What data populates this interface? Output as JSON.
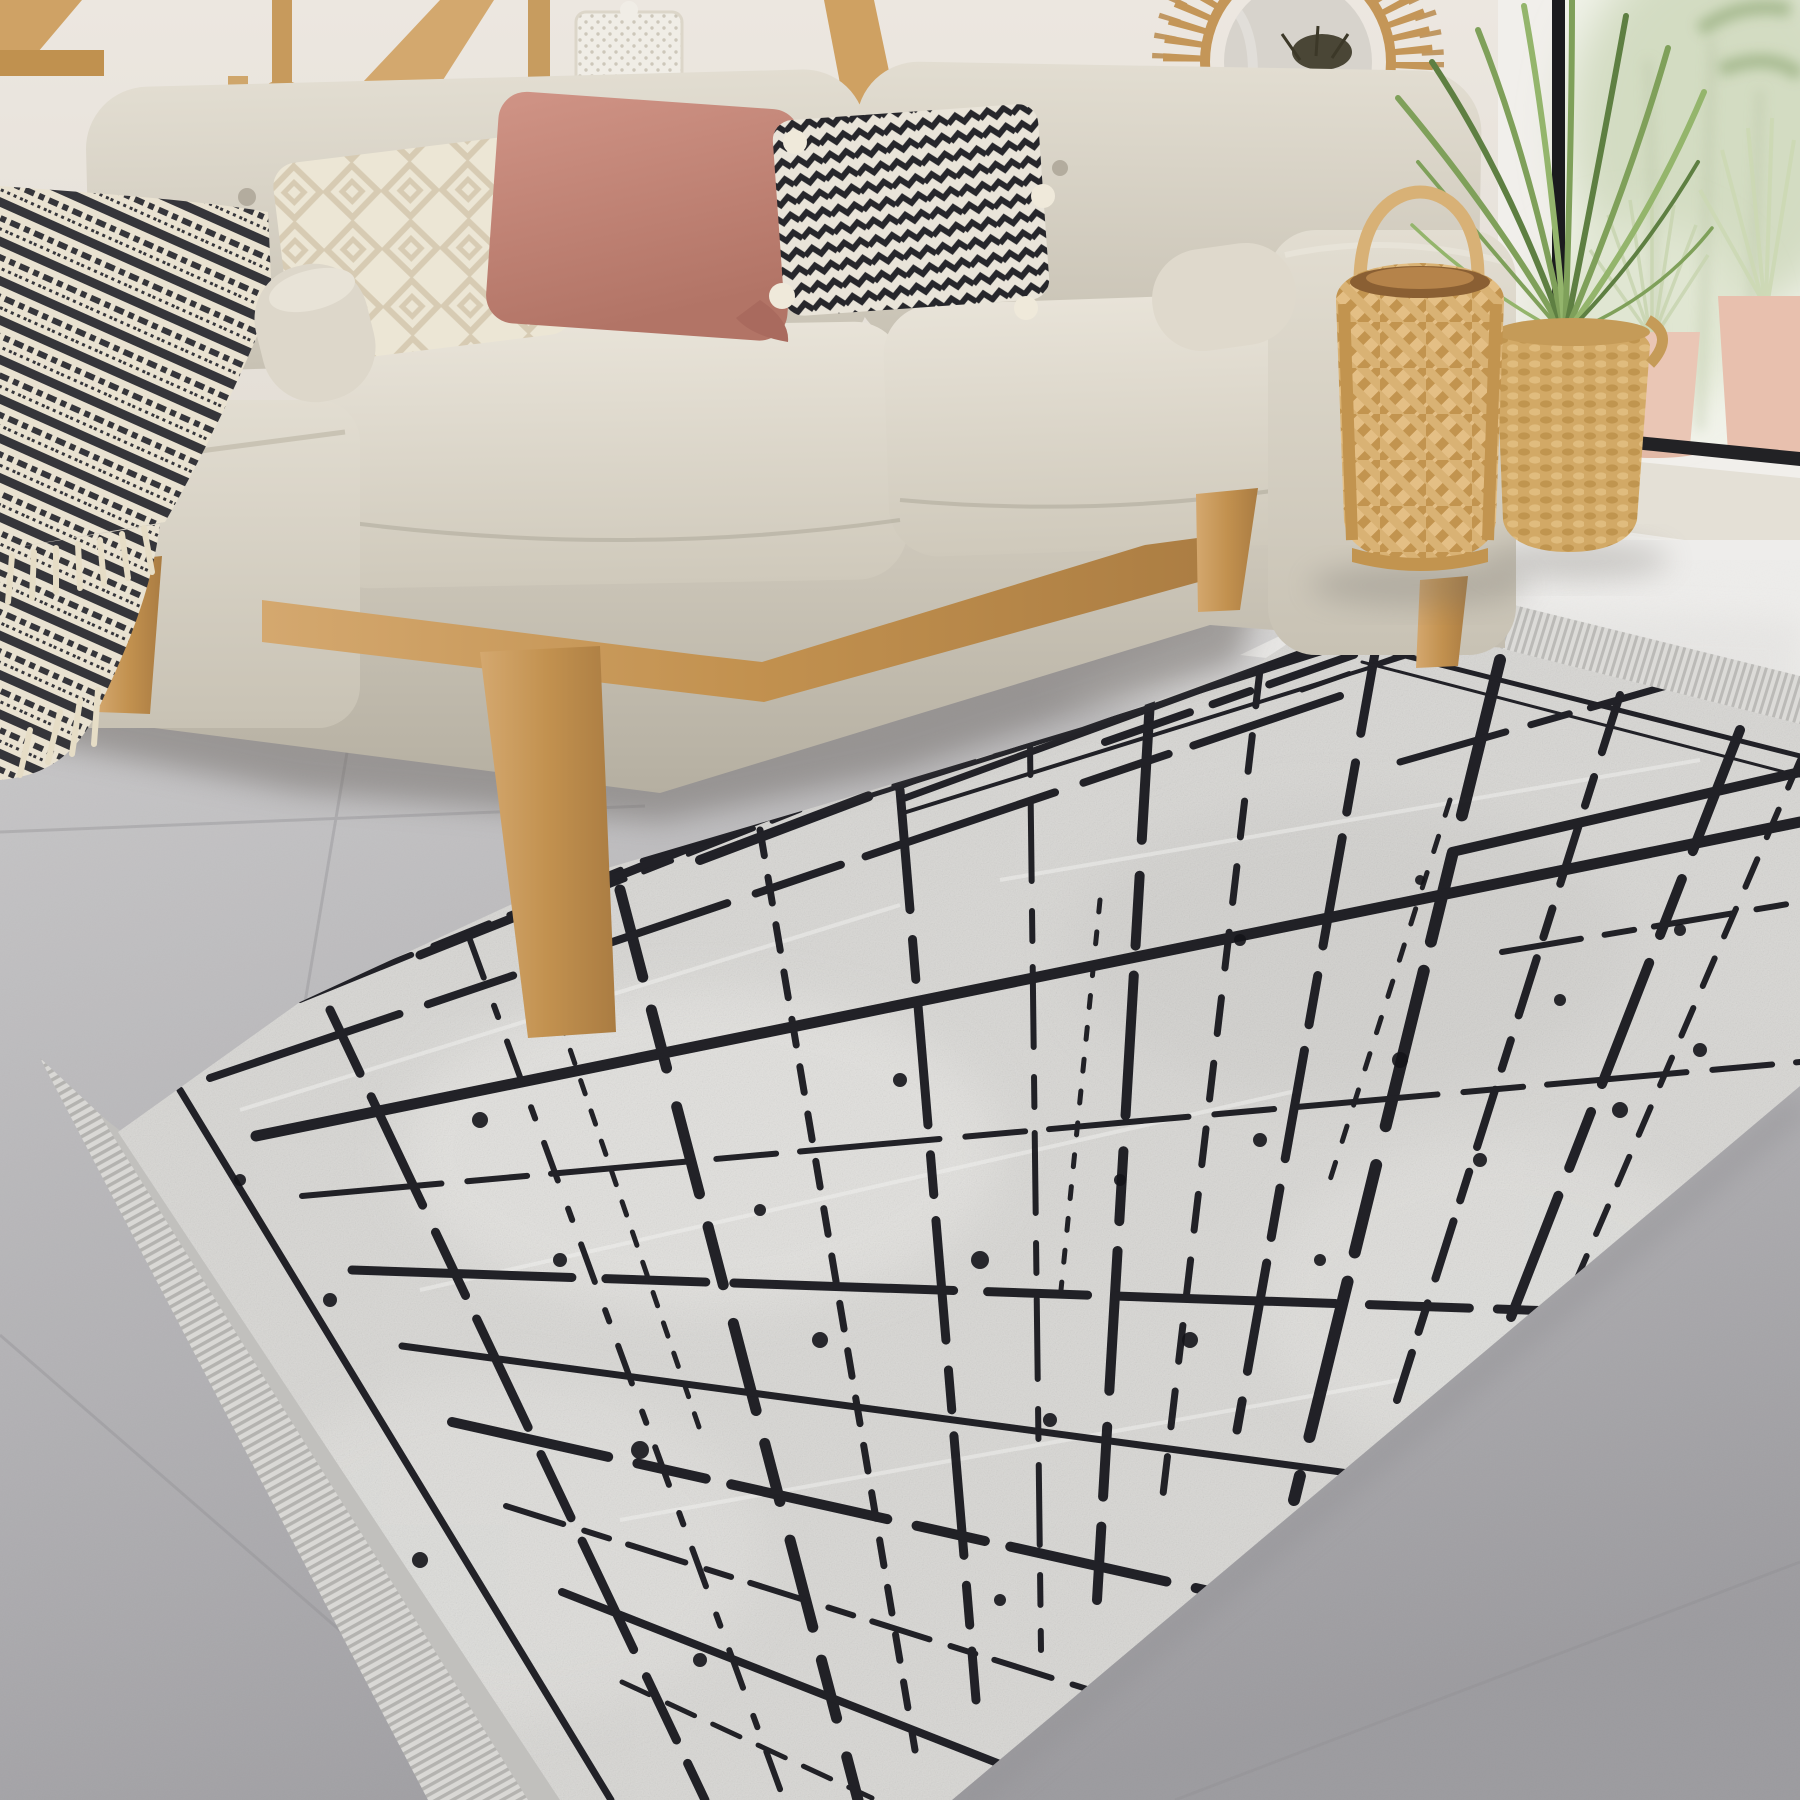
{
  "scene": {
    "type": "photograph",
    "setting": "scandinavian living room",
    "subject": "gray area rug with abstract black scratch-line pattern and fringe, beige sofa, wooden decor"
  },
  "colors": {
    "wall": "#e9e4dd",
    "wall_shadow": "#d8d1c6",
    "wood": "#c59a62",
    "wood_dark": "#a87e49",
    "wood_light": "#dcb987",
    "sofa": "#d6d0c3",
    "sofa_light": "#e6e1d5",
    "sofa_dark": "#b7b1a3",
    "seat_front": "#ccc6b9",
    "pillow_cream": "#ece6d5",
    "pillow_cream_pattern": "#d7cbb3",
    "pillow_pink": "#c98b7d",
    "pillow_pink_dark": "#b07264",
    "chevron_dark": "#26262b",
    "chevron_light": "#e9e4d9",
    "throw_dark": "#35353a",
    "throw_cream": "#e9e2d1",
    "rug_base": "#d8d7d4",
    "rug_line": "#14141a",
    "rug_fringe": "#cbcac7",
    "rug_selvage": "#c1c0bd",
    "floor": "#b5b4b6",
    "floor_dark": "#9e9da1",
    "floor_bright": "#eeedeb",
    "shadow": "#6f6b66",
    "rattan": "#c49658",
    "lantern_wood": "#e2bc82",
    "lantern_dark": "#b3894e",
    "basket": "#d2a966",
    "palm_green": "#7fa05a",
    "palm_dark": "#5e7f42",
    "window_frame_dark": "#1b1b1e",
    "window_white": "#f6f5f2",
    "glass_plants": "#d3dcc2",
    "pot_pink": "#eac6b5",
    "mirror_glass": "#d7d3cc",
    "dried_plant": "#4a4636"
  },
  "objects": {
    "area_rug": "gray rug with black abstract lines and fringe",
    "sofa": "beige three-seat fabric sofa with wood legs",
    "throw_blanket": "black and cream patterned throw on left arm",
    "pillow_diamond": "cream diamond-knit pillow",
    "pillow_pink": "dusty pink pillow",
    "pillow_chevron": "black-white chevron pillow with tassels",
    "sunburst_mirror": "rattan sunburst wall mirror",
    "floor_lantern": "woven bamboo floor lantern",
    "plant_basket": "woven basket planter with palm",
    "window": "floor window with black frame and plants",
    "candlesticks": "pair of wooden candle holders",
    "white_lantern": "white perforated candle lantern on shelf"
  }
}
